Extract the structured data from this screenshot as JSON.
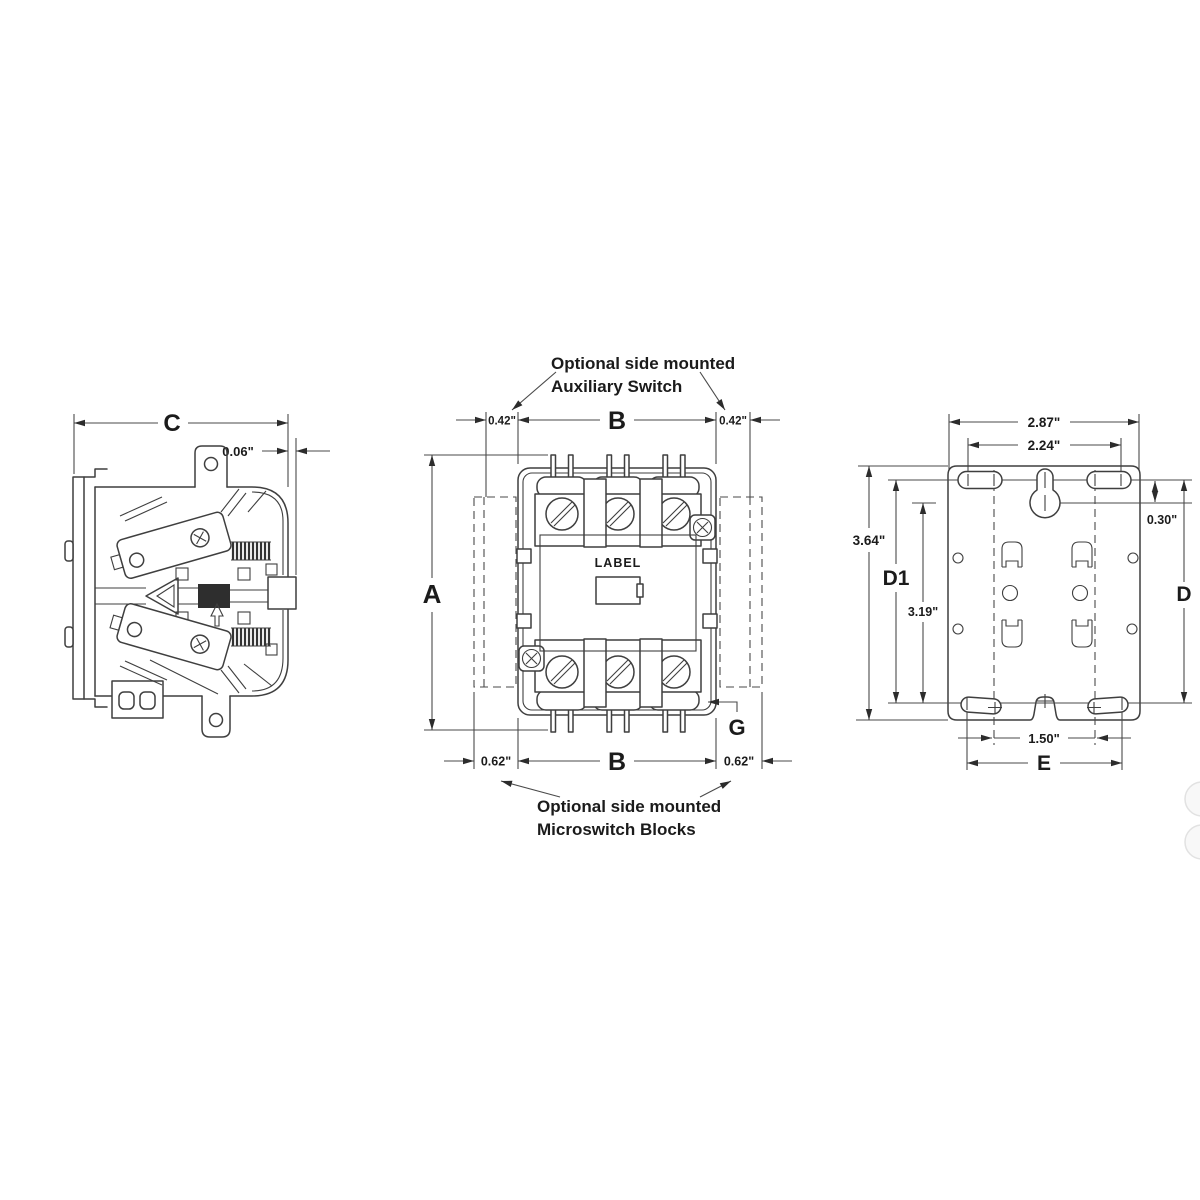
{
  "figure": {
    "kind": "technical dimensional drawing",
    "subject": "definite purpose contactor - three views",
    "background_color": "#ffffff",
    "line_color": "#3f3f3f",
    "text_color": "#1b1b1b"
  },
  "side_view": {
    "dim_width": "C",
    "dim_offset": "0.06\""
  },
  "front_view": {
    "note_aux_line1": "Optional side mounted",
    "note_aux_line2": "Auxiliary Switch",
    "dim_aux_left": "0.42\"",
    "dim_aux_right": "0.42\"",
    "dim_width_top": "B",
    "dim_width_bottom": "B",
    "dim_height": "A",
    "dim_micro_left": "0.62\"",
    "dim_micro_right": "0.62\"",
    "dim_g": "G",
    "label_text": "LABEL",
    "note_micro_line1": "Optional side mounted",
    "note_micro_line2": "Microswitch Blocks"
  },
  "plate_view": {
    "dim_width_outer": "2.87\"",
    "dim_width_inner": "2.24\"",
    "dim_height_overall": "3.64\"",
    "dim_d1": "D1",
    "dim_height_inner": "3.19\"",
    "dim_keyhole_offset": "0.30\"",
    "dim_d": "D",
    "dim_slot_inner": "1.50\"",
    "dim_e": "E"
  }
}
